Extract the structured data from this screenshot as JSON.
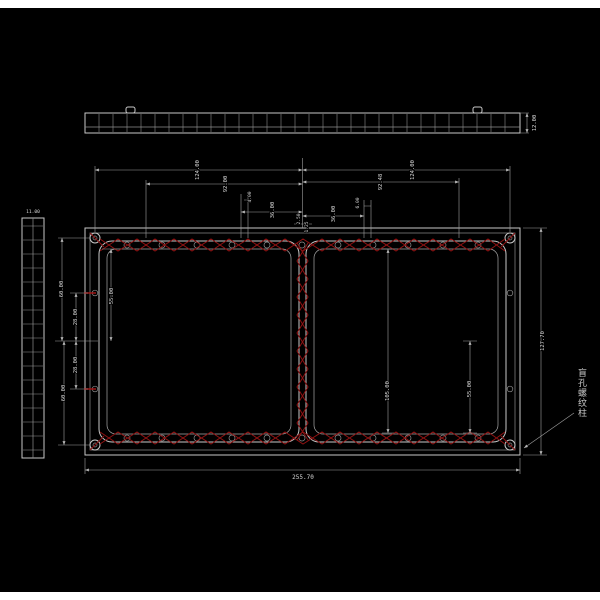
{
  "colors": {
    "background": "#000000",
    "line": "#c8c8c8",
    "dimension_line": "#9f9f9f",
    "lattice_red": "#8e1212",
    "text": "#d8d8d8"
  },
  "views": {
    "top_profile": {
      "thickness": "12.00"
    },
    "left_profile": {
      "thickness": "11.00"
    }
  },
  "dims": {
    "top": {
      "left_124": "124.00",
      "left_92": "92.00",
      "left_4": "4.00",
      "left_36": "36.00",
      "center_a": "2.50",
      "center_b": "1.25",
      "right_36": "36.00",
      "right_6": "6.00",
      "right_92": "92.48",
      "right_124": "124.00"
    },
    "left": {
      "top_60": "60.00",
      "top_28": "28.00",
      "bottom_28": "28.00",
      "bottom_60": "60.00",
      "inner_55": "55.00"
    },
    "right_inner": {
      "h_105": "105.00",
      "h_55": "55.00"
    },
    "overall": {
      "width": "255.70",
      "height": "127.70"
    }
  },
  "annotation": {
    "label": "盲孔螺纹柱"
  }
}
